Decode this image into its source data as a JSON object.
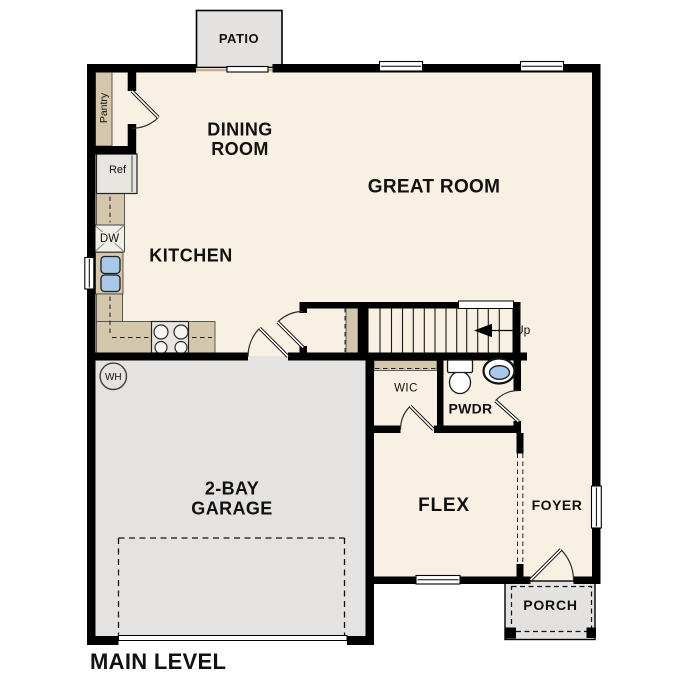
{
  "title": {
    "main_level": "MAIN LEVEL"
  },
  "colors": {
    "floor": "#f8f0e2",
    "garage_floor": "#e4e3e1",
    "outdoor": "#e3e2e0",
    "cabinet": "#d5c7ab",
    "wall": "#000000",
    "fixture_blue": "#a9c7e8",
    "appliance_gray": "#e8e6e1",
    "text": "#111111"
  },
  "rooms": {
    "patio": "PATIO",
    "dining": {
      "line1": "DINING",
      "line2": "ROOM"
    },
    "great_room": "GREAT ROOM",
    "kitchen": "KITCHEN",
    "garage": {
      "line1": "2-BAY",
      "line2": "GARAGE"
    },
    "wic": "WIC",
    "pwdr": "PWDR",
    "flex": "FLEX",
    "foyer": "FOYER",
    "porch": "PORCH"
  },
  "labels": {
    "pantry": "Pantry",
    "ref": "Ref",
    "dw": "DW",
    "wh": "WH",
    "up": "Up"
  }
}
